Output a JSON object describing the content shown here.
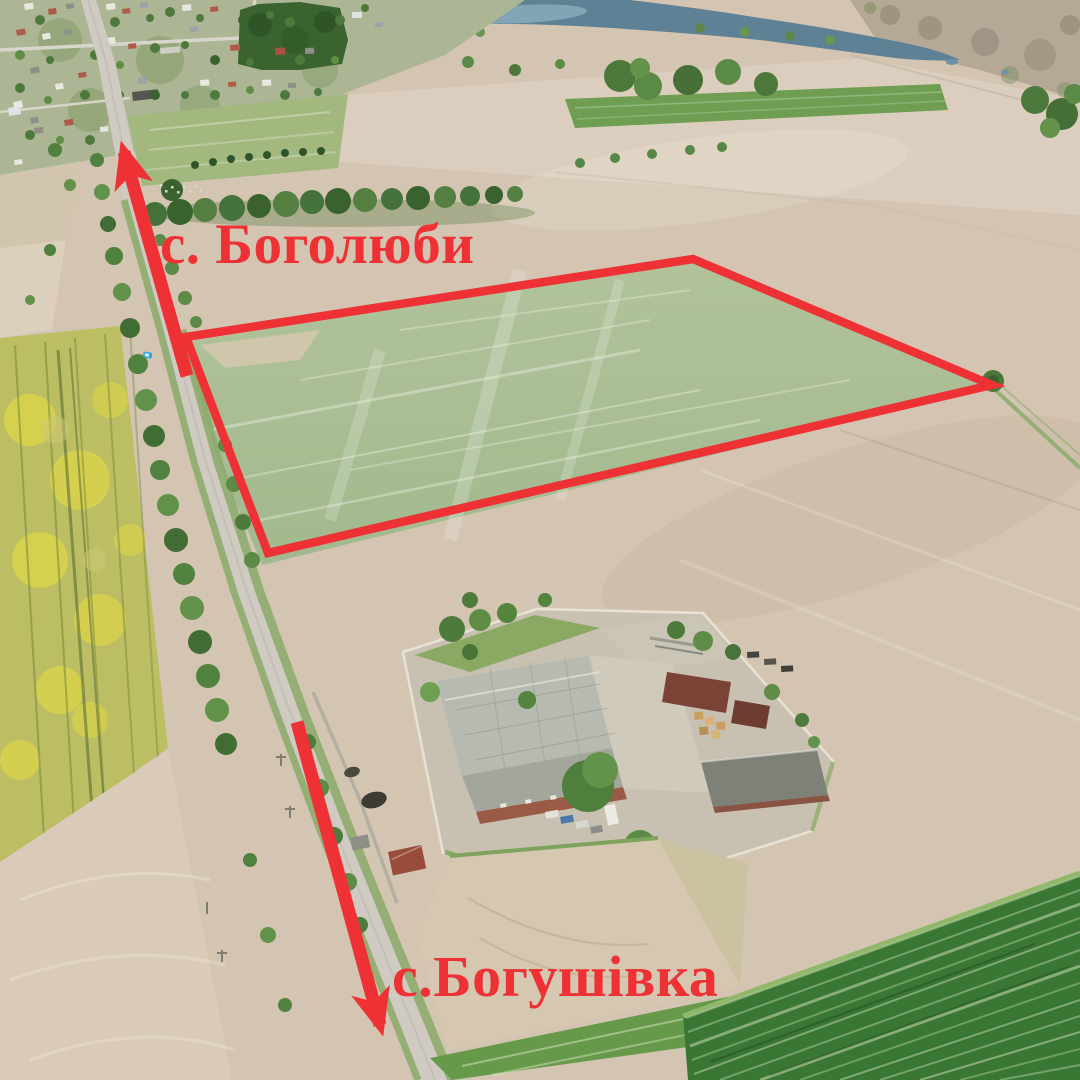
{
  "annotations": {
    "color": "#ee3135",
    "labels": [
      {
        "id": "village-north",
        "text": "с. Боголюби",
        "x": 160,
        "y": 263,
        "font_size": 57
      },
      {
        "id": "village-south",
        "text": "с.Богушівка",
        "x": 392,
        "y": 996,
        "font_size": 58
      }
    ],
    "parcel": {
      "points": "186,337 693,259 992,385 268,553"
    },
    "arrows": [
      {
        "id": "to-boholiuby",
        "x1": 187,
        "y1": 376,
        "x2": 124,
        "y2": 152
      },
      {
        "id": "to-bohushivka",
        "x1": 297,
        "y1": 722,
        "x2": 380,
        "y2": 1025
      }
    ]
  }
}
